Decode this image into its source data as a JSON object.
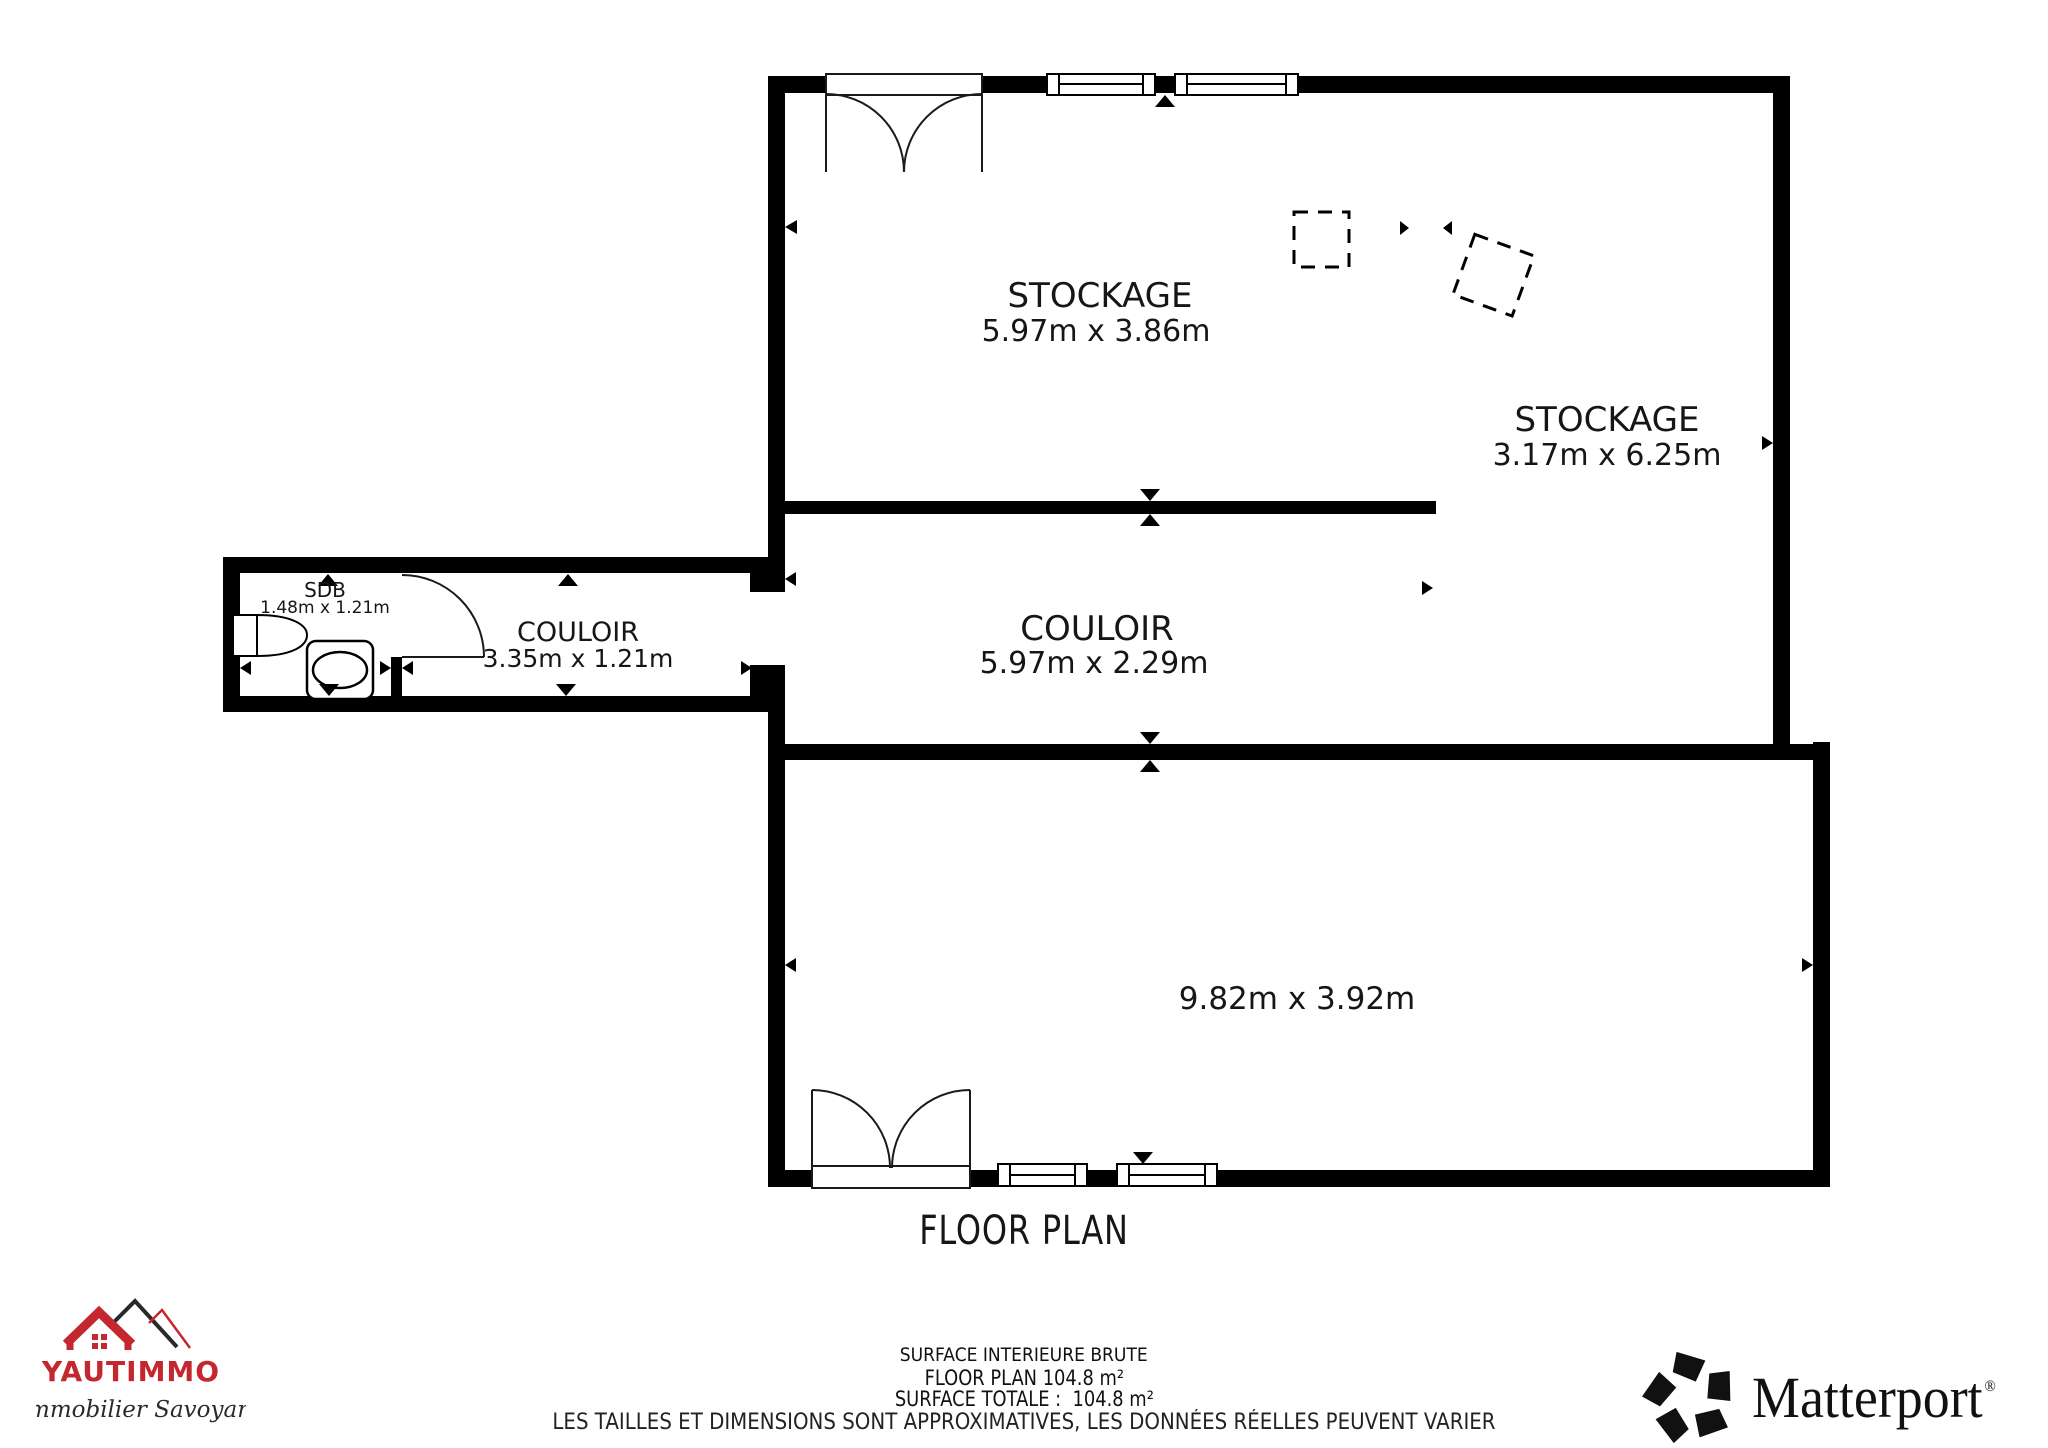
{
  "colors": {
    "wall": "#000000",
    "label": "#161616",
    "brand_red": "#c4272e",
    "brand_dark": "#2a2a2a",
    "matterport_black": "#111111"
  },
  "icons": {
    "matterport_mark": "pentagon-pinwheel",
    "yautimmo_mark": "roof-and-mountains",
    "opening_marker": "small-solid-triangle",
    "door_symbol": "quarter-arc-swing",
    "window_symbol": "framed-white-bar",
    "virtual_boundary": "dashed-square"
  },
  "plan": {
    "title": "FLOOR PLAN",
    "rooms": [
      {
        "id": "stockage-left",
        "name": "STOCKAGE",
        "dims": "5.97m x 3.86m"
      },
      {
        "id": "stockage-right",
        "name": "STOCKAGE",
        "dims": "3.17m x 6.25m"
      },
      {
        "id": "couloir-main",
        "name": "COULOIR",
        "dims": "5.97m x 2.29m"
      },
      {
        "id": "couloir-small",
        "name": "COULOIR",
        "dims": "3.35m x 1.21m"
      },
      {
        "id": "sdb",
        "name": "SDB",
        "dims": "1.48m x 1.21m"
      },
      {
        "id": "grande-piece",
        "name": "",
        "dims": "9.82m x 3.92m"
      }
    ]
  },
  "footer": {
    "line1": "SURFACE INTERIEURE BRUTE",
    "line2": "FLOOR PLAN 104.8 m²",
    "line3": "SURFACE TOTALE :  104.8 m²",
    "line4": "LES TAILLES ET DIMENSIONS SONT APPROXIMATIVES, LES DONNÉES RÉELLES PEUVENT VARIER"
  },
  "logos": {
    "yautimmo": {
      "name": "YAUTIMMO",
      "tagline": "L'immobilier Savoyard"
    },
    "matterport": {
      "name": "Matterport",
      "registered": "®"
    }
  }
}
